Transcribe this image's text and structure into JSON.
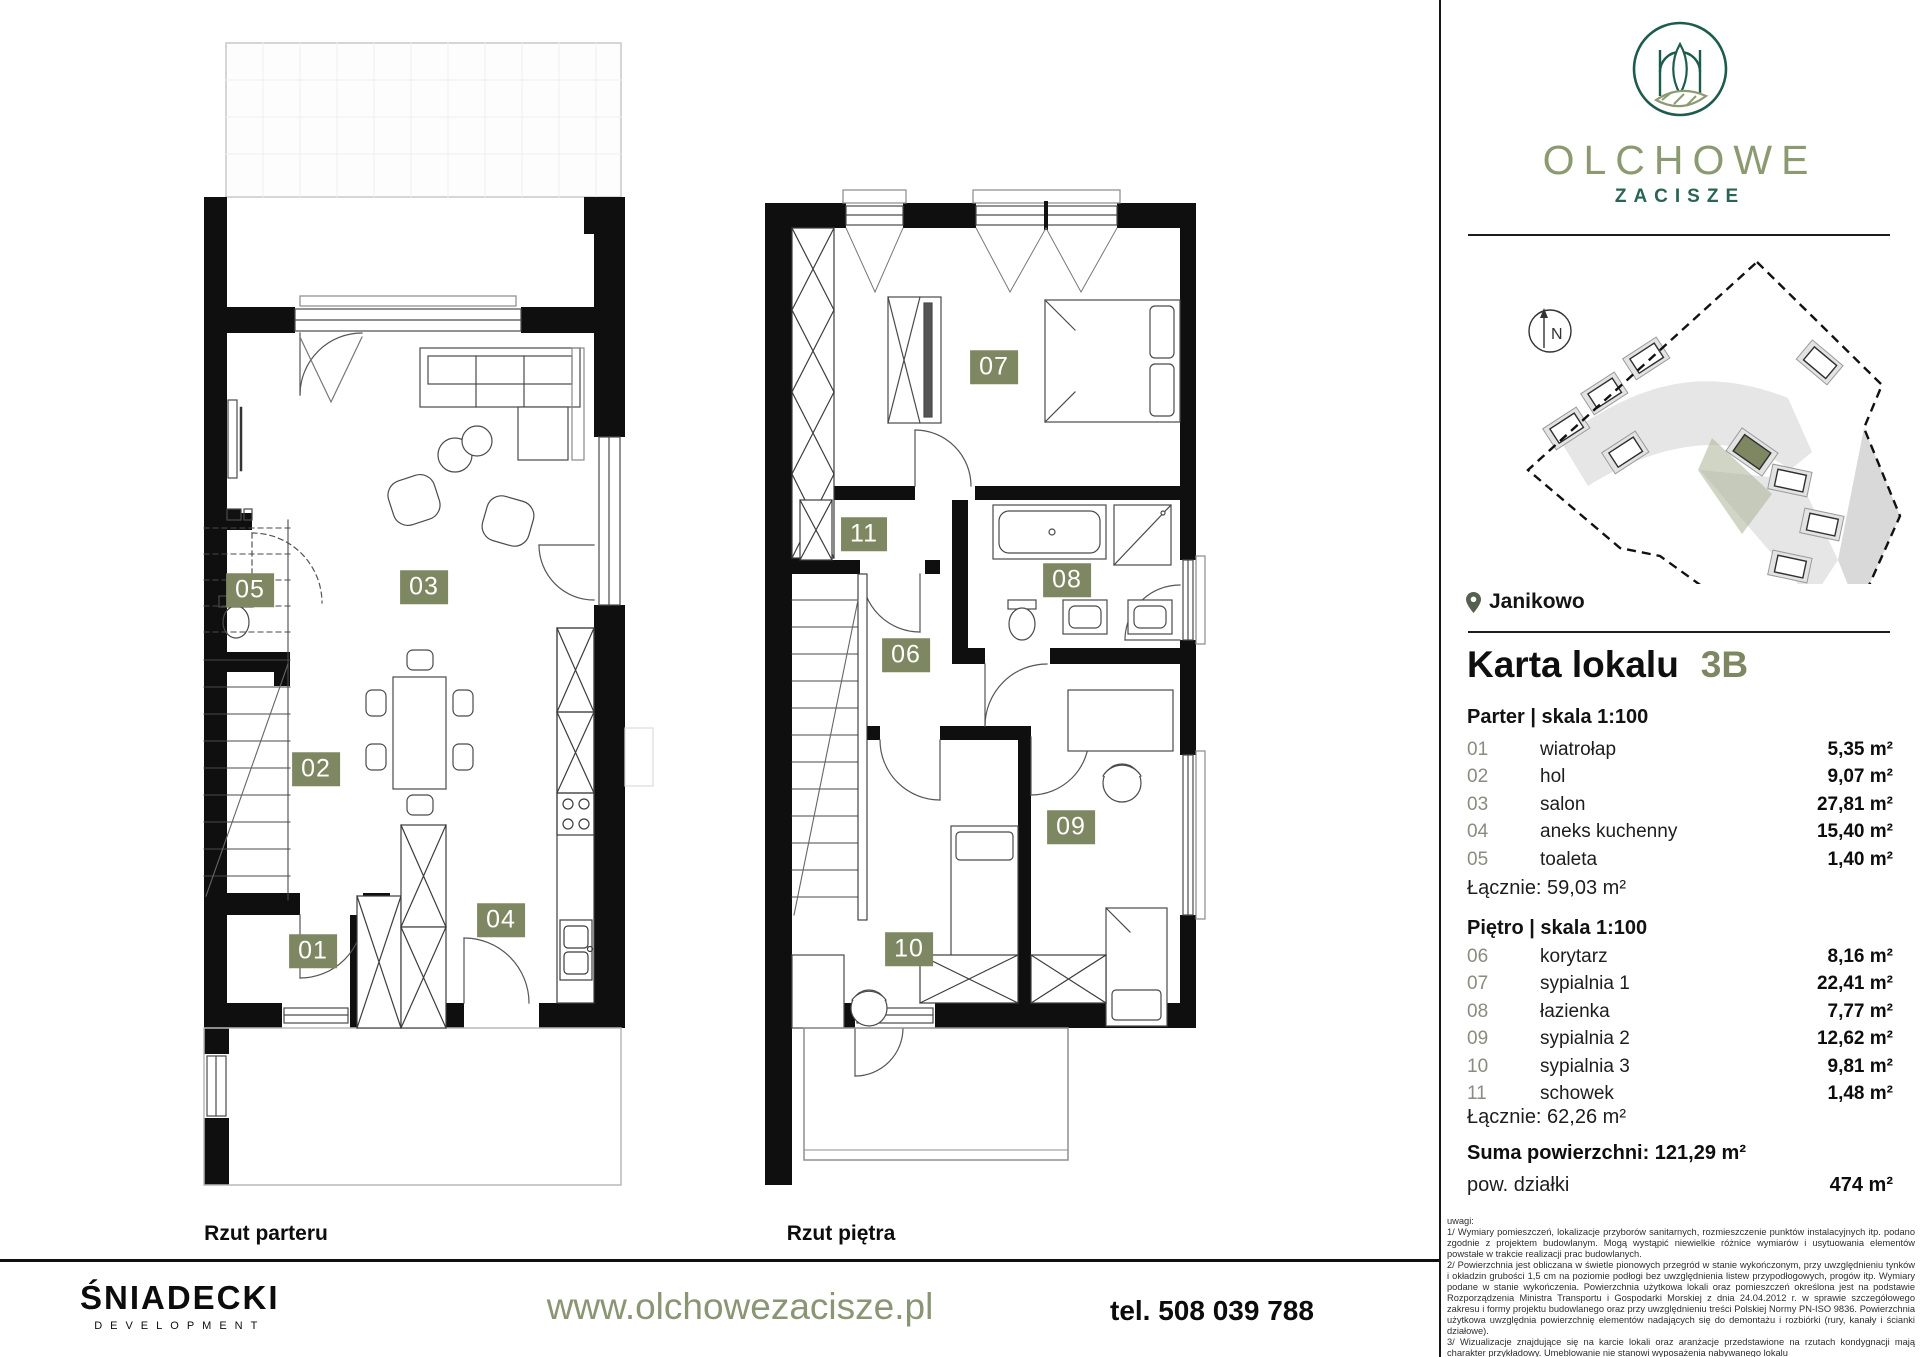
{
  "brand": {
    "name": "OLCHOWE",
    "subname": "ZACISZE",
    "developer": "ŚNIADECKI",
    "developer_sub": "DEVELOPMENT"
  },
  "location": {
    "city": "Janikowo"
  },
  "compass": {
    "label": "N"
  },
  "unit": {
    "card_title": "Karta lokalu",
    "unit_id": "3B",
    "floors": [
      {
        "heading": "Parter | skala 1:100",
        "rooms": [
          {
            "no": "01",
            "name": "wiatrołap",
            "area": "5,35 m²"
          },
          {
            "no": "02",
            "name": "hol",
            "area": "9,07 m²"
          },
          {
            "no": "03",
            "name": "salon",
            "area": "27,81 m²"
          },
          {
            "no": "04",
            "name": "aneks kuchenny",
            "area": "15,40 m²"
          },
          {
            "no": "05",
            "name": "toaleta",
            "area": "1,40 m²"
          }
        ],
        "total": "Łącznie: 59,03 m²"
      },
      {
        "heading": "Piętro | skala 1:100",
        "rooms": [
          {
            "no": "06",
            "name": "korytarz",
            "area": "8,16 m²"
          },
          {
            "no": "07",
            "name": "sypialnia 1",
            "area": "22,41 m²"
          },
          {
            "no": "08",
            "name": "łazienka",
            "area": "7,77 m²"
          },
          {
            "no": "09",
            "name": "sypialnia 2",
            "area": "12,62 m²"
          },
          {
            "no": "10",
            "name": "sypialnia 3",
            "area": "9,81 m²"
          },
          {
            "no": "11",
            "name": "schowek",
            "area": "1,48 m²"
          }
        ],
        "total": "Łącznie: 62,26 m²"
      }
    ],
    "sum_label": "Suma powierzchni: 121,29 m²",
    "plot_label": "pow. działki",
    "plot_area": "474 m²"
  },
  "plans": {
    "parter": {
      "caption": "Rzut parteru",
      "labels": [
        "01",
        "02",
        "03",
        "04",
        "05"
      ]
    },
    "pietro": {
      "caption": "Rzut piętra",
      "labels": [
        "06",
        "07",
        "08",
        "09",
        "10",
        "11"
      ]
    }
  },
  "notes": {
    "title": "uwagi:",
    "items": [
      "1/ Wymiary pomieszczeń, lokalizacje przyborów sanitarnych, rozmieszczenie punktów instalacyjnych itp. podano zgodnie z projektem budowlanym. Mogą wystąpić niewielkie różnice wymiarów i usytuowania elementów powstałe w trakcie realizacji prac budowlanych.",
      "2/ Powierzchnia jest obliczana w świetle pionowych przegród w stanie wykończonym, przy uwzględnieniu tynków i okładzin grubości 1,5 cm na poziomie podłogi bez uwzględnienia listew przypodłogowych, progów itp. Wymiary podane w stanie wykończenia. Powierzchnia użytkowa lokali oraz pomieszczeń określona jest na podstawie Rozporządzenia Ministra Transportu i Gospodarki Morskiej z dnia 24.04.2012 r. w sprawie szczegółowego zakresu i formy projektu budowlanego oraz przy uwzględnieniu treści Polskiej Normy PN-ISO 9836. Powierzchnia użytkowa uwzględnia powierzchnię elementów nadających się do demontażu i rozbiórki (rury, kanały i ścianki działowe).",
      "3/ Wizualizacje znajdujące się na karcie lokali oraz aranżacje przedstawione na rzutach kondygnacji mają charakter przykładowy. Umeblowanie nie stanowi wyposażenia nabywanego lokalu"
    ]
  },
  "footer": {
    "website": "www.olchowezacisze.pl",
    "phone": "tel. 508 039 788"
  },
  "colors": {
    "accent": "#7d8862",
    "accent_text": "#8a9573",
    "logo_dark": "#1d5c4d",
    "logo_olive": "#8c9a72",
    "wall": "#0f0f0f"
  }
}
